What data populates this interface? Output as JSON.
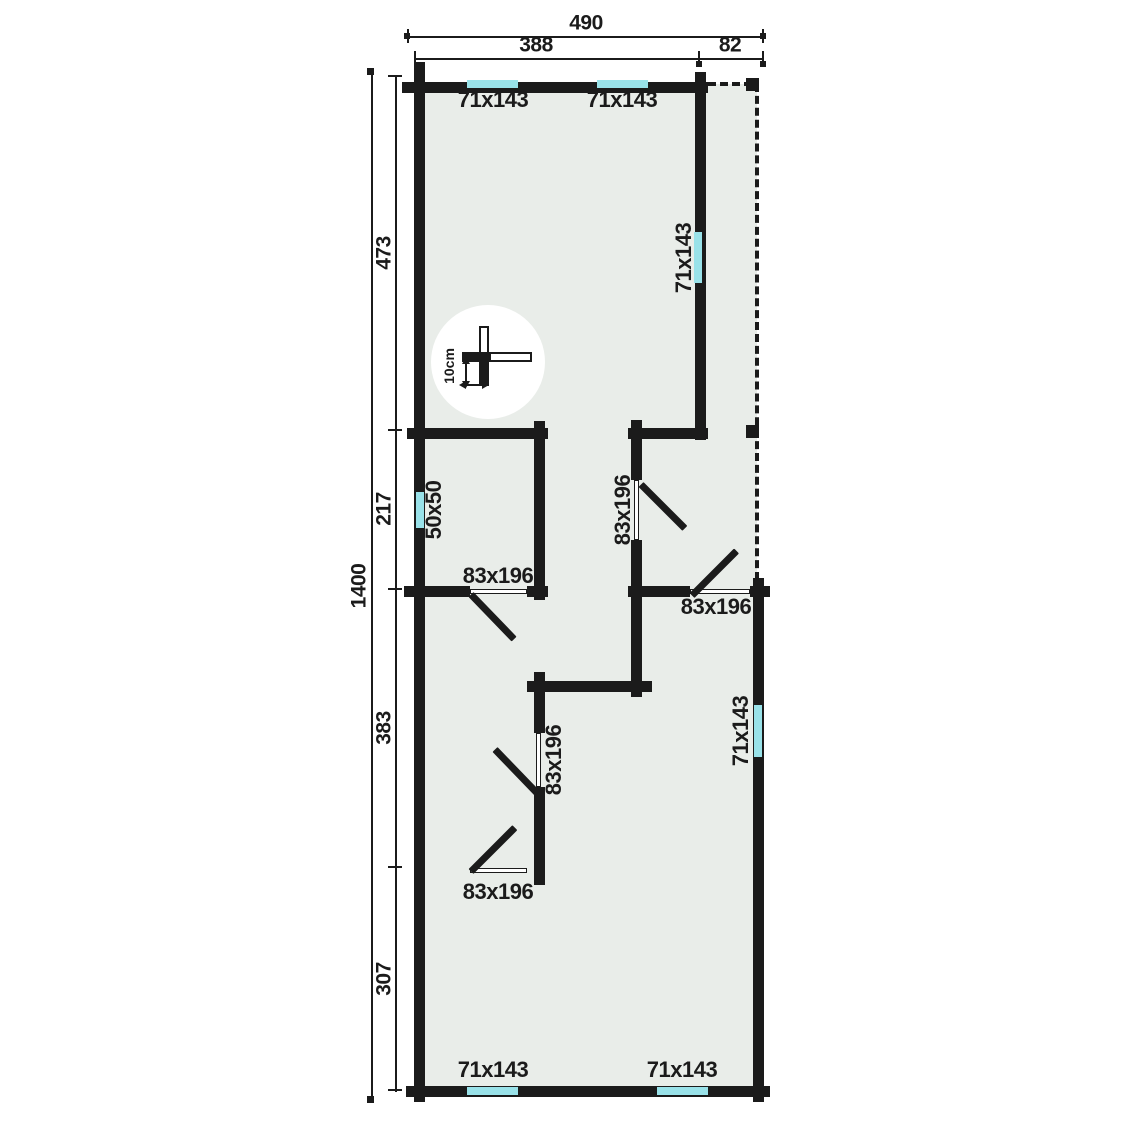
{
  "colors": {
    "wall": "#1b1b1b",
    "floor": "#e9ede9",
    "window": "#99e2e9",
    "ink": "#1b1b1b",
    "paper": "#ffffff"
  },
  "dimensions": {
    "overall_width": "490",
    "main_width": "388",
    "porch_width": "82",
    "overall_height": "1400",
    "segment_top": "473",
    "segment_upper_mid": "217",
    "segment_lower_mid": "383",
    "segment_bottom": "307"
  },
  "labels": {
    "window_top_left": "71x143",
    "window_top_right": "71x143",
    "window_gable_wall": "71x143",
    "window_right_wall": "71x143",
    "window_bottom_left": "71x143",
    "window_bottom_right": "71x143",
    "window_small_left": "50x50",
    "door_left_room": "83x196",
    "door_center_upper": "83x196",
    "door_right_room": "83x196",
    "door_center_lower": "83x196",
    "door_bottom_room": "83x196",
    "scale_note": "10cm"
  }
}
